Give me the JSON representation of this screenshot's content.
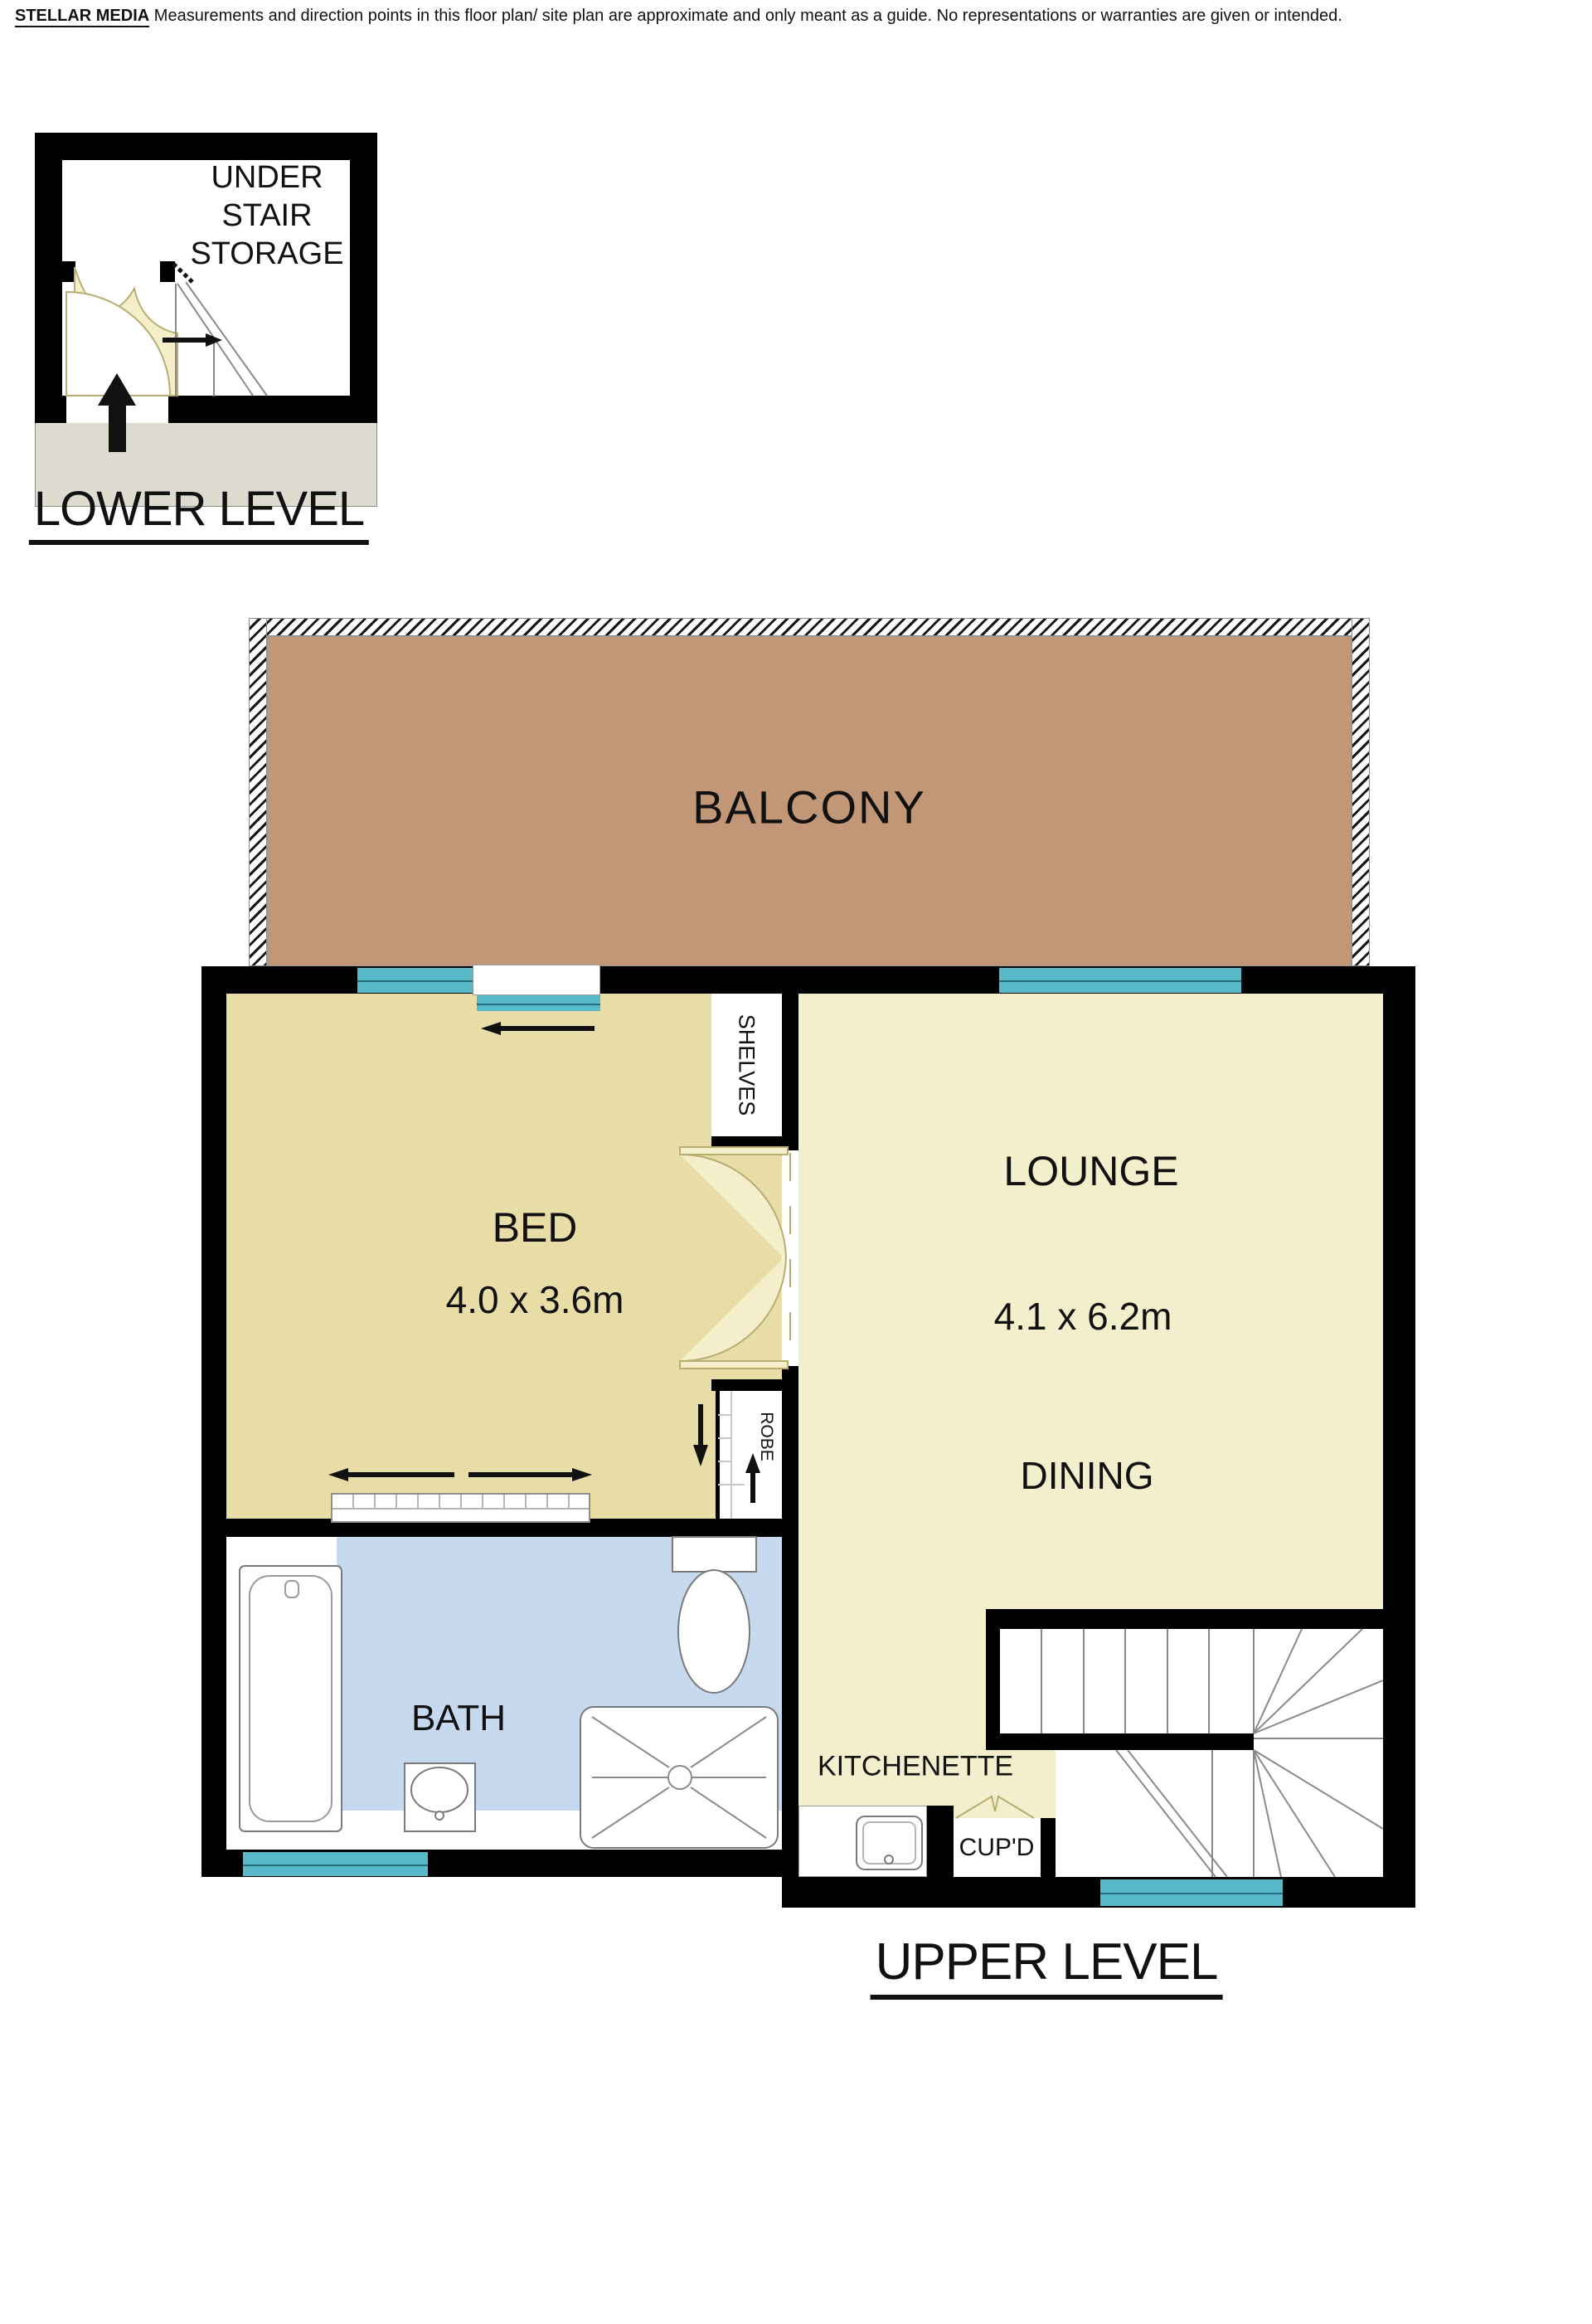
{
  "disclaimer": {
    "brand": "STELLAR MEDIA",
    "text": "Measurements and direction points in this floor plan/ site plan are approximate and only meant as a guide. No representations or warranties are given or intended."
  },
  "lower_level": {
    "title": "LOWER LEVEL",
    "storage_lines": [
      "UNDER",
      "STAIR",
      "STORAGE"
    ]
  },
  "upper_level": {
    "title": "UPPER LEVEL",
    "balcony_label": "BALCONY",
    "bed_label": "BED",
    "bed_dims": "4.0 x 3.6m",
    "lounge_label": "LOUNGE",
    "lounge_dims": "4.1 x 6.2m",
    "dining_label": "DINING",
    "bath_label": "BATH",
    "kitchenette_label": "KITCHENETTE",
    "cupboard_label": "CUP'D",
    "shelves_label": "SHELVES",
    "robe_label": "ROBE"
  },
  "colors": {
    "wall": "#000000",
    "text": "#111111",
    "bed-floor": "#e9dda7",
    "lounge-floor": "#f3eecb",
    "bath-floor": "#c7d9ef",
    "balcony": "#c29778",
    "window": "#58bac9",
    "ground": "#dedcd0",
    "swing": "#f4eeca",
    "line": "#8a8a8a"
  }
}
